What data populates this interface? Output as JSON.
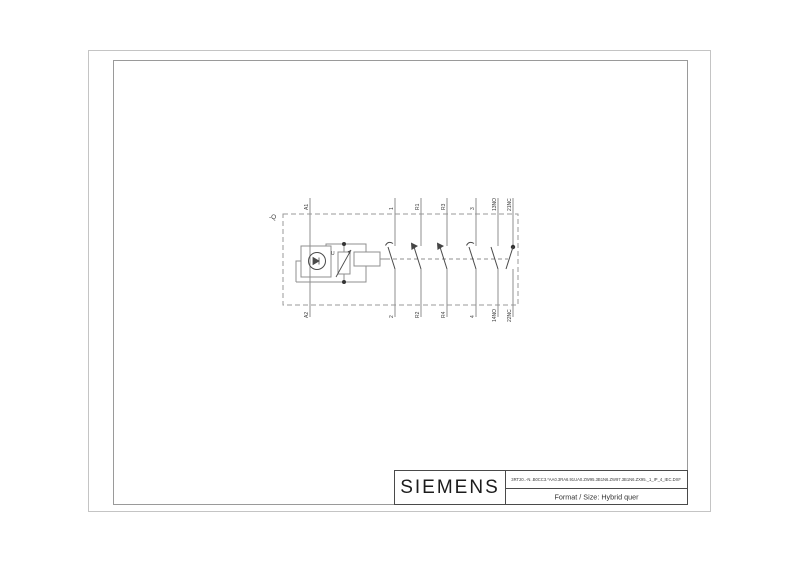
{
  "page": {
    "width": 800,
    "height": 565,
    "background": "#ffffff"
  },
  "title_block": {
    "brand": "SIEMENS",
    "document_code": "3RT20..-N..B0CC3.*AA0.3RA6.91UA0.ZW95.3B1N6.ZW97.3B1N6.ZX95._1_IP_4_IEC.DXF",
    "format_line": "Format / Size: Hybrid quer"
  },
  "schematic": {
    "device_tag": "-Q",
    "varistor_label": "U",
    "top_terminals": [
      "A1",
      "1",
      "R1",
      "R3",
      "3",
      "13NO",
      "21NC"
    ],
    "bottom_terminals": [
      "A2",
      "2",
      "R2",
      "R4",
      "4",
      "14NO",
      "22NC"
    ],
    "colors": {
      "conductor": "#8f8f8f",
      "contact": "#444444",
      "enclosure_dash": "#9a9a9a",
      "frame_outer": "#c4c4c4",
      "frame_inner": "#9a9a9a"
    }
  }
}
